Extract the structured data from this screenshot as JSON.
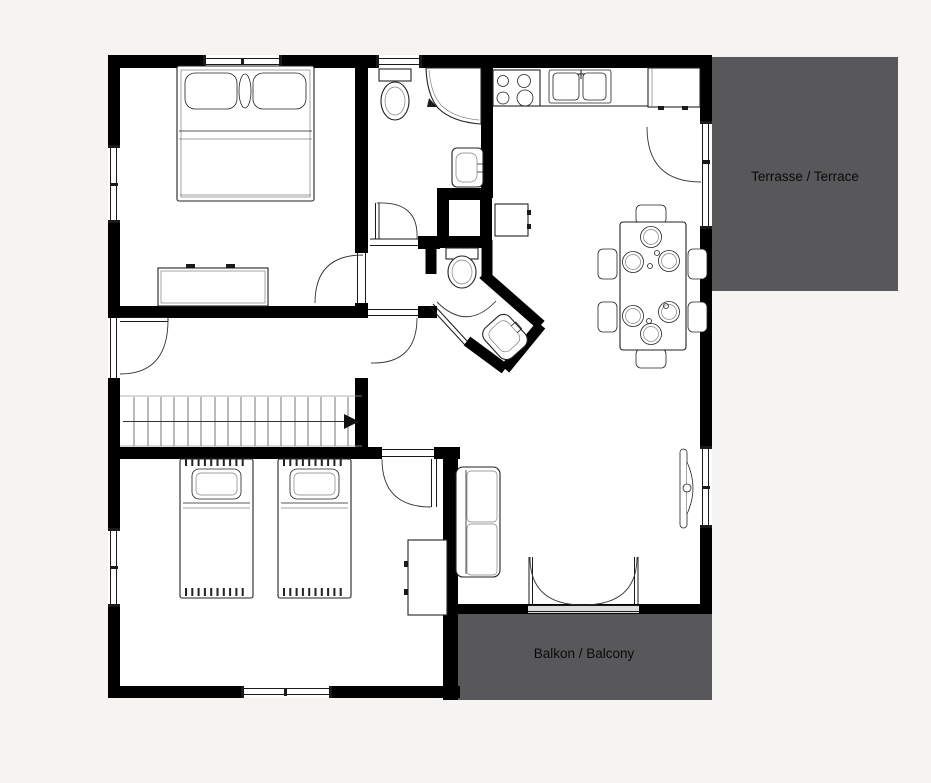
{
  "canvas": {
    "width": 931,
    "height": 783,
    "background": "#f5f4f2"
  },
  "floor_plan": {
    "colors": {
      "wall": "#000000",
      "floor": "#ffffff",
      "outdoor_fill": "#58585a",
      "outline": "#222222",
      "label_text": "#0a0a0a"
    },
    "terrace": {
      "label": "Terrasse / Terrace"
    },
    "balcony": {
      "label": "Balkon / Balcony"
    }
  }
}
